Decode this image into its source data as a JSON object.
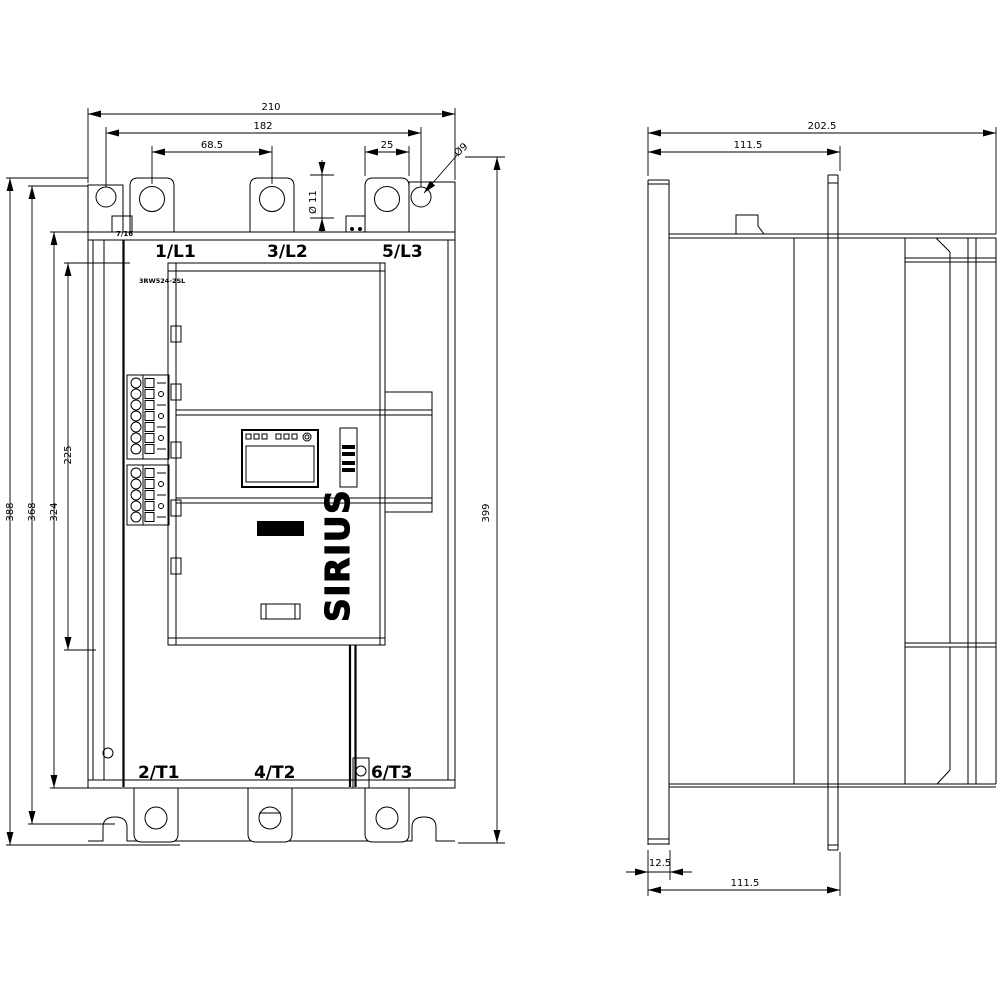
{
  "front": {
    "dims": {
      "overall_width": "210",
      "mounting_hole_spacing_x": "182",
      "terminal_pitch": "68.5",
      "terminal_width": "25",
      "mounting_hole_dia": "Ø9",
      "terminal_slot_dia": "Ø 11",
      "overall_height": "388",
      "mounting_hole_spacing_y": "368",
      "body_height": "324",
      "cover_height": "225",
      "total_height_right": "399"
    },
    "terminals_top": [
      "1/L1",
      "3/L2",
      "5/L3"
    ],
    "terminals_bottom": [
      "2/T1",
      "4/T2",
      "6/T3"
    ],
    "brand": "SIEMENS",
    "series": "SIRIUS",
    "product_code": "3RW524-2SL",
    "small_marking": "7/16"
  },
  "side": {
    "dims": {
      "overall_depth": "202.5",
      "upper_depth": "111.5",
      "rail_width": "12.5",
      "lower_depth": "111.5"
    }
  }
}
